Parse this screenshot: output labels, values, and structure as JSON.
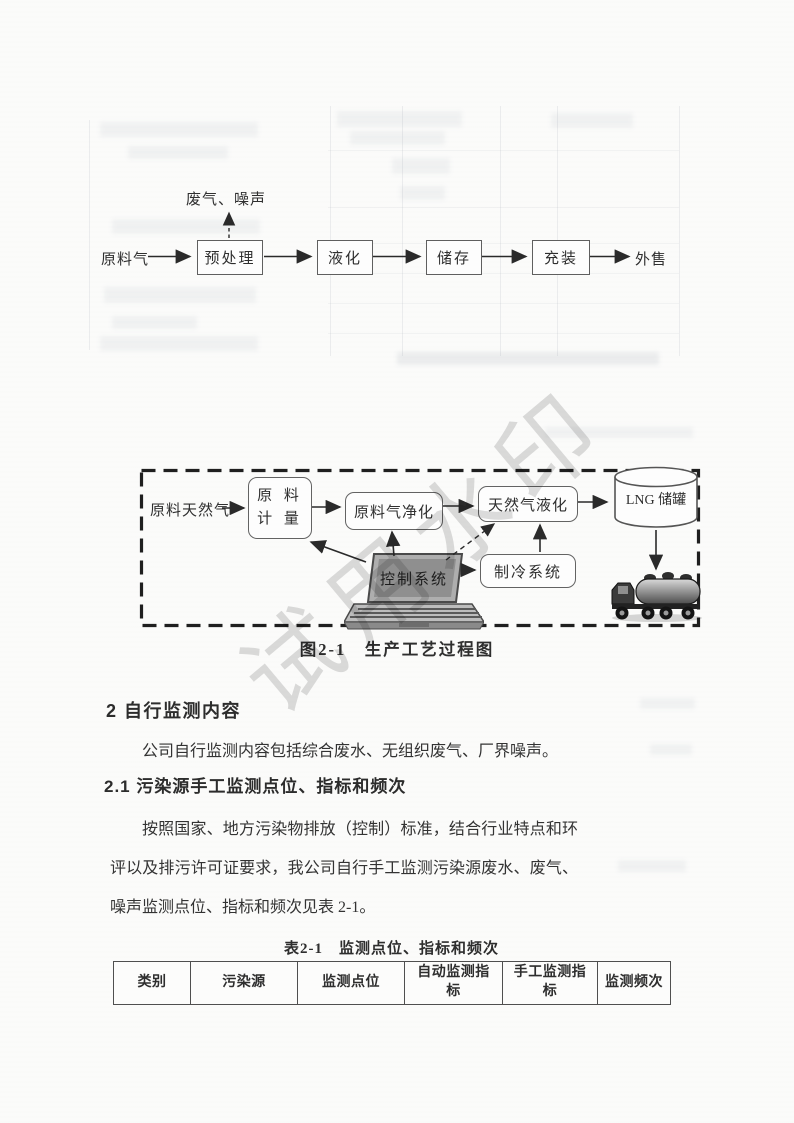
{
  "flow_top": {
    "input": "原料气",
    "emission": "废气、噪声",
    "steps": [
      "预处理",
      "液化",
      "储存",
      "充装"
    ],
    "output": "外售"
  },
  "diagram": {
    "input": "原料天然气",
    "metering_line1": "原 料",
    "metering_line2": "计 量",
    "purification": "原料气净化",
    "liquefaction": "天然气液化",
    "refrigeration": "制冷系统",
    "control": "控制系统",
    "storage": "LNG 储罐",
    "caption": "图2-1　生产工艺过程图"
  },
  "content": {
    "heading2": "2 自行监测内容",
    "para1": "公司自行监测内容包括综合废水、无组织废气、厂界噪声。",
    "heading21": "2.1 污染源手工监测点位、指标和频次",
    "para2": "按照国家、地方污染物排放（控制）标准，结合行业特点和环评以及排污许可证要求，我公司自行手工监测污染源废水、废气、噪声监测点位、指标和频次见表 2-1。"
  },
  "table": {
    "caption": "表2-1　监测点位、指标和频次",
    "headers": [
      "类别",
      "污染源",
      "监测点位",
      "自动监测指标",
      "手工监测指标",
      "监测频次"
    ]
  },
  "watermark": "试用水印",
  "colors": {
    "ink": "#3a3a3a",
    "box_border": "#5f5f5f",
    "watermark": "#c6c6c6"
  }
}
